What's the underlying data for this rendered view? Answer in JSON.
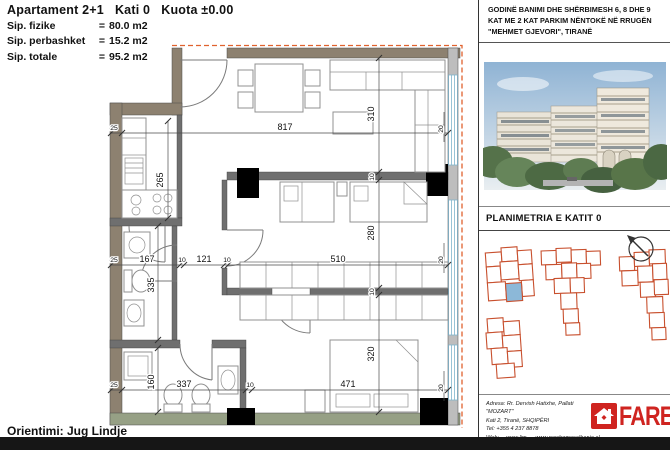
{
  "header": {
    "title": "Apartament 2+1   Kati 0   Kuota ±0.00",
    "rows": [
      {
        "label": "Sip. fizike",
        "eq": "=",
        "value": "80.0 m2"
      },
      {
        "label": "Sip. perbashket",
        "eq": "=",
        "value": "15.2 m2"
      },
      {
        "label": "Sip. totale",
        "eq": "=",
        "value": "95.2 m2"
      }
    ]
  },
  "orientation_label": "Orientimi: Jug Lindje",
  "plan": {
    "dims": {
      "d817": "817",
      "d310": "310",
      "d265": "265",
      "d280": "280",
      "d320": "320",
      "d335": "335",
      "d160": "160",
      "d510": "510",
      "d471": "471",
      "d337": "337",
      "d167": "167",
      "d121": "121",
      "d25_top": "25",
      "d25_mid": "25",
      "d25_bot": "25",
      "d10_a": "10",
      "d10_b": "10",
      "d10_c": "10",
      "d10_top": "10",
      "d10_mid": "10",
      "d20_top": "20",
      "d20_mid": "20",
      "d20_bot": "20"
    }
  },
  "panel": {
    "project_title_lines": [
      "GODINË BANIMI DHE SHËRBIMESH 6, 8 DHE 9",
      "KAT ME 2 KAT PARKIM NËNTOKË NË RRUGËN",
      "\"MEHMET GJEVORI\", TIRANË"
    ],
    "plan_section_title": "PLANIMETRIA E KATIT 0",
    "contact": {
      "address_line1": "Adresa: Rr. Dervish Hatixhe, Pallati \"MOZART\"",
      "address_line2": "Kati 2, Tiranë, SHQIPËRI",
      "tel": "Tel: +355 4 237 8878",
      "web_label": "Web:",
      "web1": "www.lim-em.al",
      "web2": "www.newhomesalbania.al",
      "email_label": "email:",
      "email1": "info@lim-em.al;",
      "email2": "marketing@lim-em.al"
    },
    "logo_text": "FARE"
  },
  "colors": {
    "brand_red": "#cf2420",
    "site_outline_orange": "#c8502e",
    "unit_highlight_blue": "#8cb8d8",
    "window_blue": "#7fb4cc",
    "exterior_dash_orange": "#e0622e"
  }
}
